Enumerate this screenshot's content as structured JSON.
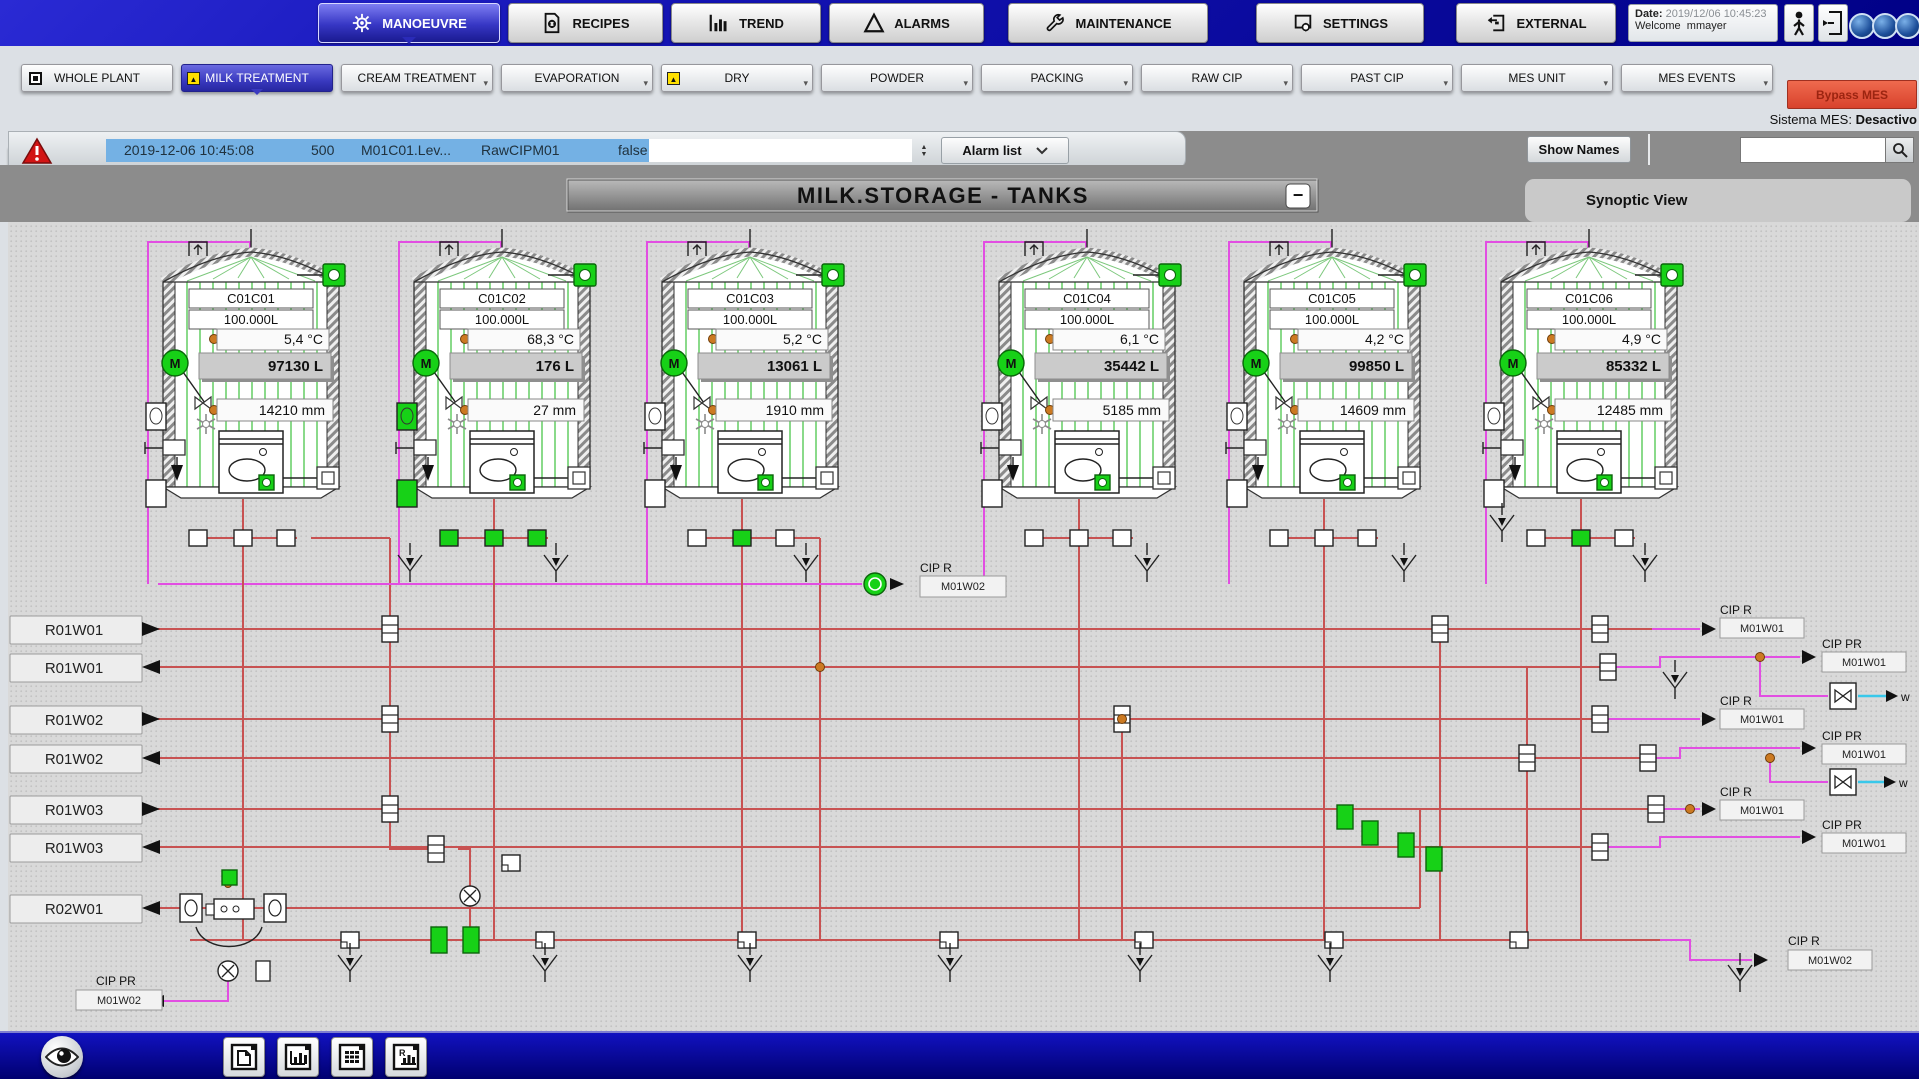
{
  "colors": {
    "white": "#ffffff",
    "green": "#17d117",
    "topbar_blue": "#1414b4",
    "active_tab_blue": "#3636c4",
    "subtab_purple": "#8d93d2",
    "subtab_active_navy": "#000a7e",
    "alarm_highlight_blue": "#74b1e4",
    "alarm_triangle_red": "#d21414",
    "bypass_red": "#d8422c",
    "band_gray": "#8c8c8c",
    "pipe_red": "#c85252",
    "pipe_magenta": "#e24ee2",
    "pipe_cyan": "#38c8ea",
    "orange_junction": "#cc7a22",
    "tank_stripe_green": "#3cc23c"
  },
  "top_nav": {
    "tabs": [
      {
        "label": "MANOEUVRE"
      },
      {
        "label": "RECIPES"
      },
      {
        "label": "TREND"
      },
      {
        "label": "ALARMS"
      },
      {
        "label": "MAINTENANCE"
      },
      {
        "label": "SETTINGS"
      },
      {
        "label": "EXTERNAL"
      }
    ]
  },
  "session": {
    "date_label": "Date:",
    "date_value": "2019/12/06 10:45:23",
    "welcome_label": "Welcome",
    "user": "mmayer"
  },
  "plant_tabs": [
    {
      "label": "WHOLE PLANT"
    },
    {
      "label": "MILK TREATMENT"
    },
    {
      "label": "CREAM TREATMENT"
    },
    {
      "label": "EVAPORATION"
    },
    {
      "label": "DRY"
    },
    {
      "label": "POWDER"
    },
    {
      "label": "PACKING"
    },
    {
      "label": "RAW CIP"
    },
    {
      "label": "PAST CIP"
    },
    {
      "label": "MES UNIT"
    },
    {
      "label": "MES EVENTS"
    }
  ],
  "sub_tabs": [
    {
      "label": "RECEPTION"
    },
    {
      "label": "RECEPTION GEA"
    },
    {
      "label": "MILK STORG.TANK"
    },
    {
      "label": "MILK DIPT.LINES"
    },
    {
      "label": "MILK STD.LINE"
    }
  ],
  "mes": {
    "bypass_label": "Bypass MES",
    "status_label": "Sistema MES:",
    "status_value": "Desactivo"
  },
  "alarm_bar": {
    "timestamp": "2019-12-06 10:45:08",
    "code": "500",
    "tag": "M01C01.Lev...",
    "source": "RawCIPM01",
    "value": "false",
    "dropdown_label": "Alarm list"
  },
  "toolbar": {
    "show_names_label": "Show Names",
    "search_value": ""
  },
  "synoptic": {
    "title": "MILK.STORAGE - TANKS",
    "minimize_label": "−",
    "panel_title": "Synoptic View"
  },
  "tanks": [
    {
      "id": "C01C01",
      "capacity": "100.000L",
      "temp": "5,4 °C",
      "volume": "97130 L",
      "level": "14210 mm",
      "valves": [
        "white",
        "white",
        "white"
      ],
      "left_valve": "white"
    },
    {
      "id": "C01C02",
      "capacity": "100.000L",
      "temp": "68,3 °C",
      "volume": "176 L",
      "level": "27 mm",
      "valves": [
        "green",
        "green",
        "green"
      ],
      "left_valve": "green"
    },
    {
      "id": "C01C03",
      "capacity": "100.000L",
      "temp": "5,2 °C",
      "volume": "13061 L",
      "level": "1910 mm",
      "valves": [
        "white",
        "green",
        "white"
      ],
      "left_valve": "white"
    },
    {
      "id": "C01C04",
      "capacity": "100.000L",
      "temp": "6,1 °C",
      "volume": "35442 L",
      "level": "5185 mm",
      "valves": [
        "white",
        "white",
        "white"
      ],
      "left_valve": "white"
    },
    {
      "id": "C01C05",
      "capacity": "100.000L",
      "temp": "4,2 °C",
      "volume": "99850 L",
      "level": "14609 mm",
      "valves": [
        "white",
        "white",
        "white"
      ],
      "left_valve": "white"
    },
    {
      "id": "C01C06",
      "capacity": "100.000L",
      "temp": "4,9 °C",
      "volume": "85332 L",
      "level": "12485 mm",
      "valves": [
        "white",
        "green",
        "white"
      ],
      "left_valve": "white"
    }
  ],
  "route_lines": [
    {
      "label": "R01W01",
      "dir": "out"
    },
    {
      "label": "R01W01",
      "dir": "in"
    },
    {
      "label": "R01W02",
      "dir": "out"
    },
    {
      "label": "R01W02",
      "dir": "in"
    },
    {
      "label": "R01W03",
      "dir": "out"
    },
    {
      "label": "R01W03",
      "dir": "in"
    },
    {
      "label": "R02W01",
      "dir": "in"
    }
  ],
  "cip": {
    "mid": {
      "title": "CIP R",
      "tag": "M01W02"
    },
    "right": [
      {
        "title": "CIP R",
        "tag": "M01W01"
      },
      {
        "title": "CIP PR",
        "tag": "M01W01"
      },
      {
        "title": "CIP R",
        "tag": "M01W01"
      },
      {
        "title": "CIP PR",
        "tag": "M01W01"
      },
      {
        "title": "CIP R",
        "tag": "M01W01"
      },
      {
        "title": "CIP PR",
        "tag": "M01W01"
      },
      {
        "title": "CIP R",
        "tag": "M01W02"
      }
    ],
    "bottom_left": {
      "title": "CIP PR",
      "tag": "M01W02"
    },
    "water_label": "w"
  }
}
